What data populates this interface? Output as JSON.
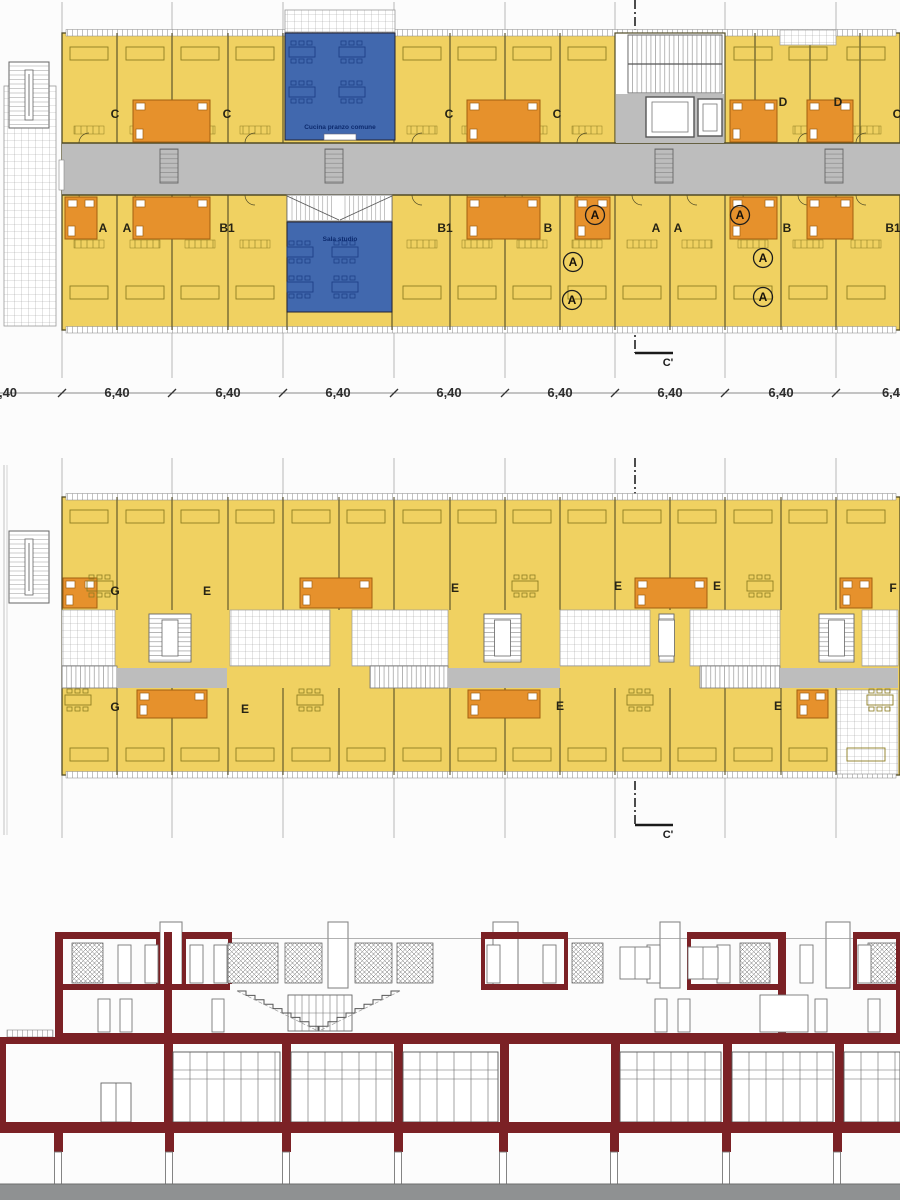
{
  "palette": {
    "room_yellow": "#f0d161",
    "furniture_line": "#8d7d22",
    "wall_dark": "#514b25",
    "bath_orange": "#e6912c",
    "bath_orange_dark": "#a2600f",
    "common_blue": "#4168ae",
    "common_blue_dark": "#1e3f88",
    "common_text_blue": "#0c2a6e",
    "corridor_gray": "#bdbdbd",
    "grid_line_gray": "#9a9a9a",
    "section_maroon": "#7b2125",
    "ground_gray": "#8f9192",
    "text_dark": "#2e2e2e"
  },
  "top_plan": {
    "name": "typical-floor-plan-with-central-corridor",
    "room_labels": [
      {
        "label": "C",
        "x": 115,
        "y": 118
      },
      {
        "label": "C",
        "x": 227,
        "y": 118
      },
      {
        "label": "C",
        "x": 449,
        "y": 118
      },
      {
        "label": "C",
        "x": 557,
        "y": 118
      },
      {
        "label": "D",
        "x": 783,
        "y": 106
      },
      {
        "label": "D",
        "x": 838,
        "y": 106
      },
      {
        "label": "C",
        "x": 897,
        "y": 118
      },
      {
        "label": "A",
        "x": 103,
        "y": 232
      },
      {
        "label": "A",
        "x": 127,
        "y": 232
      },
      {
        "label": "B1",
        "x": 227,
        "y": 232
      },
      {
        "label": "B1",
        "x": 445,
        "y": 232
      },
      {
        "label": "B",
        "x": 548,
        "y": 232
      },
      {
        "label": "A",
        "x": 656,
        "y": 232
      },
      {
        "label": "A",
        "x": 678,
        "y": 232
      },
      {
        "label": "B",
        "x": 787,
        "y": 232
      },
      {
        "label": "B1",
        "x": 893,
        "y": 232
      }
    ],
    "common_rooms": [
      {
        "label": "Cucina pranzo comune",
        "x": 340,
        "y": 129
      },
      {
        "label": "Sala studio",
        "x": 340,
        "y": 241
      }
    ],
    "accessibility_marks": {
      "symbol": "A",
      "positions": [
        [
          595,
          215
        ],
        [
          573,
          262
        ],
        [
          572,
          300
        ],
        [
          740,
          215
        ],
        [
          763,
          258
        ],
        [
          763,
          297
        ]
      ]
    },
    "section_mark": {
      "label": "C'",
      "x": 668,
      "y": 366
    }
  },
  "mid_plan": {
    "name": "upper-gallery-floor-plan",
    "room_labels": [
      {
        "label": "G",
        "x": 115,
        "y": 595
      },
      {
        "label": "E",
        "x": 207,
        "y": 595
      },
      {
        "label": "E",
        "x": 455,
        "y": 592
      },
      {
        "label": "E",
        "x": 618,
        "y": 590
      },
      {
        "label": "E",
        "x": 717,
        "y": 590
      },
      {
        "label": "F",
        "x": 893,
        "y": 592
      },
      {
        "label": "G",
        "x": 115,
        "y": 711
      },
      {
        "label": "E",
        "x": 245,
        "y": 713
      },
      {
        "label": "E",
        "x": 560,
        "y": 710
      },
      {
        "label": "E",
        "x": 778,
        "y": 710
      }
    ],
    "section_mark": {
      "label": "C'",
      "x": 668,
      "y": 838
    }
  },
  "section_drawing": {
    "name": "cross-section-through-building"
  },
  "dimensions": {
    "unit_value": "6,40",
    "y": 397,
    "labels": [
      {
        "text": ",40",
        "x": 8
      },
      {
        "text": "6,40",
        "x": 117
      },
      {
        "text": "6,40",
        "x": 228
      },
      {
        "text": "6,40",
        "x": 338
      },
      {
        "text": "6,40",
        "x": 449
      },
      {
        "text": "6,40",
        "x": 560
      },
      {
        "text": "6,40",
        "x": 670
      },
      {
        "text": "6,40",
        "x": 781
      },
      {
        "text": "6,4",
        "x": 891
      }
    ]
  }
}
